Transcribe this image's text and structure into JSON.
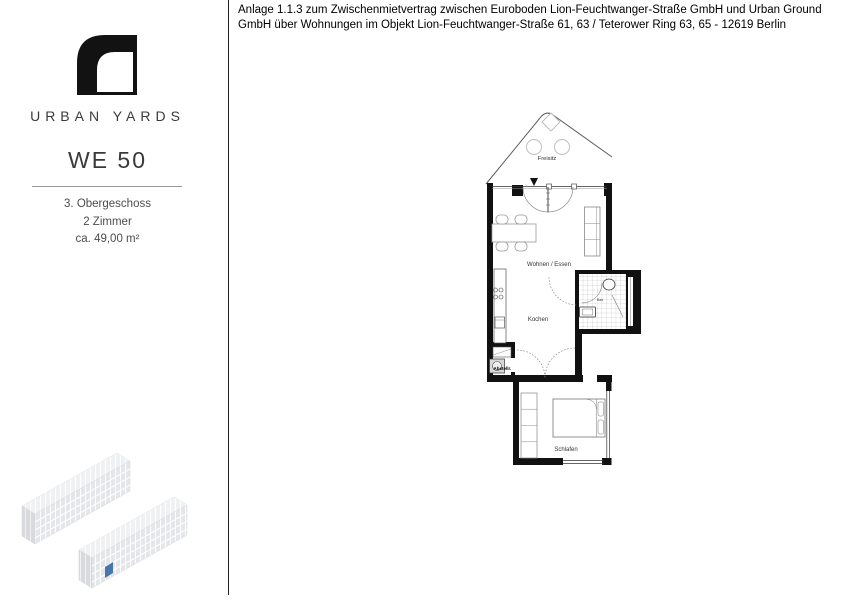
{
  "header": {
    "attachment_note": "Anlage 1.1.3 zum Zwischenmietvertrag zwischen Euroboden Lion-Feuchtwanger-Straße GmbH und Urban Ground GmbH über Wohnungen im Objekt Lion-Feuchtwanger-Straße 61, 63 / Teterower Ring 63, 65 - 12619 Berlin"
  },
  "sidebar": {
    "brand_name": "URBAN YARDS",
    "unit_id": "WE 50",
    "floor": "3. Obergeschoss",
    "rooms_count": "2 Zimmer",
    "area": "ca. 49,00 m²"
  },
  "floorplan": {
    "labels": {
      "terrace": "Freisitz",
      "living_dining": "Wohnen / Essen",
      "kitchen": "Kochen",
      "bath": "Bad",
      "storage": "Abstellr.",
      "bedroom": "Schlafen"
    }
  },
  "colors": {
    "wall": "#111111",
    "building_fill": "#e4e6e9",
    "unit_marker": "#4878aa"
  }
}
